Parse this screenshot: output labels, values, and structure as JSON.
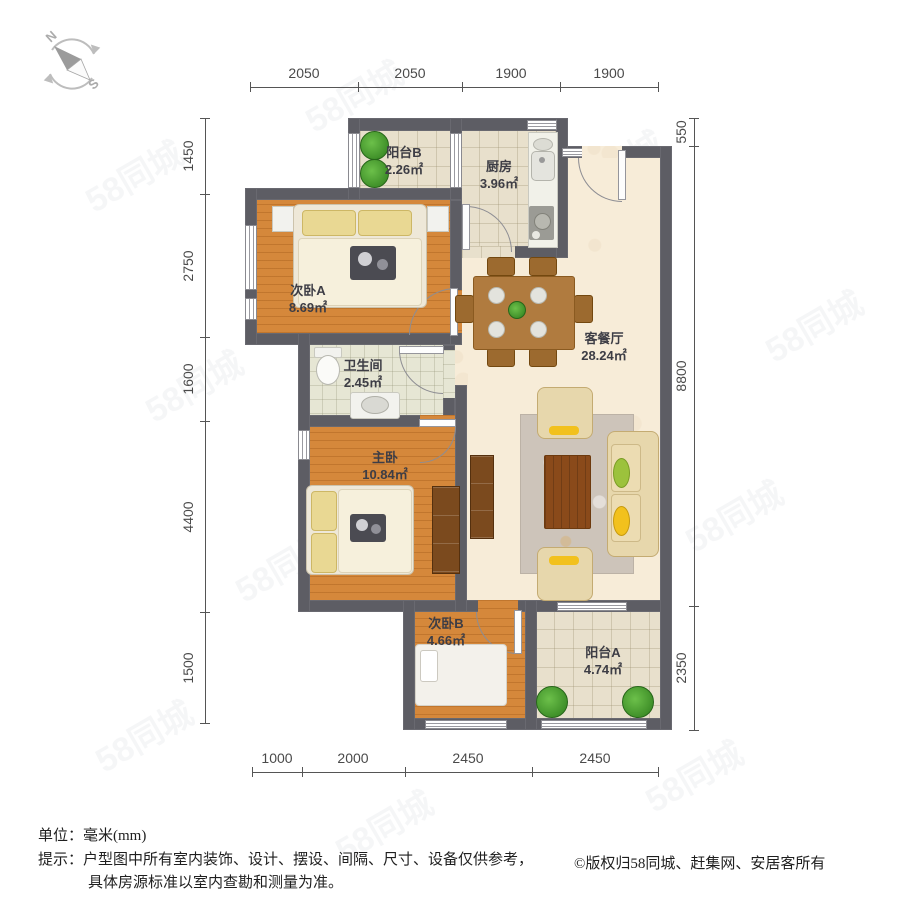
{
  "compass": {
    "north": "N",
    "south": "S"
  },
  "dimensions": {
    "top": [
      "2050",
      "2050",
      "1900",
      "1900"
    ],
    "bottom": [
      "1000",
      "2000",
      "2450",
      "2450"
    ],
    "left": [
      "1450",
      "2750",
      "1600",
      "4400",
      "1500"
    ],
    "right": [
      "550",
      "8800",
      "2350"
    ]
  },
  "rooms": [
    {
      "id": "balcony-b",
      "name": "阳台B",
      "area": "2.26㎡"
    },
    {
      "id": "kitchen",
      "name": "厨房",
      "area": "3.96㎡"
    },
    {
      "id": "bedroom-a",
      "name": "次卧A",
      "area": "8.69㎡"
    },
    {
      "id": "bathroom",
      "name": "卫生间",
      "area": "2.45㎡"
    },
    {
      "id": "master-bedroom",
      "name": "主卧",
      "area": "10.84㎡"
    },
    {
      "id": "living-dining",
      "name": "客餐厅",
      "area": "28.24㎡"
    },
    {
      "id": "bedroom-b",
      "name": "次卧B",
      "area": "4.66㎡"
    },
    {
      "id": "balcony-a",
      "name": "阳台A",
      "area": "4.74㎡"
    }
  ],
  "footer": {
    "unit_label": "单位：",
    "unit_value": "毫米(mm)",
    "tip_label": "提示：",
    "tip_line1": "户型图中所有室内装饰、设计、摆设、间隔、尺寸、设备仅供参考，",
    "tip_line2": "具体房源标准以室内查勘和测量为准。",
    "copyright": "©版权归58同城、赶集网、安居客所有"
  },
  "watermark": {
    "text": "58同城"
  },
  "colors": {
    "wall": "#5d5d64",
    "wood_floor": "#d5883b",
    "tile_floor": "#e8e0cc",
    "living_floor": "#f7ecd8",
    "bath_floor": "#e6e6d4",
    "plant": "#3fa32c",
    "sofa": "#e7d7ac",
    "cushion_yellow": "#f2c11d",
    "cushion_green": "#9cc23c",
    "cabinet": "#7b4a1e",
    "dim_text": "#4a4a4a"
  }
}
